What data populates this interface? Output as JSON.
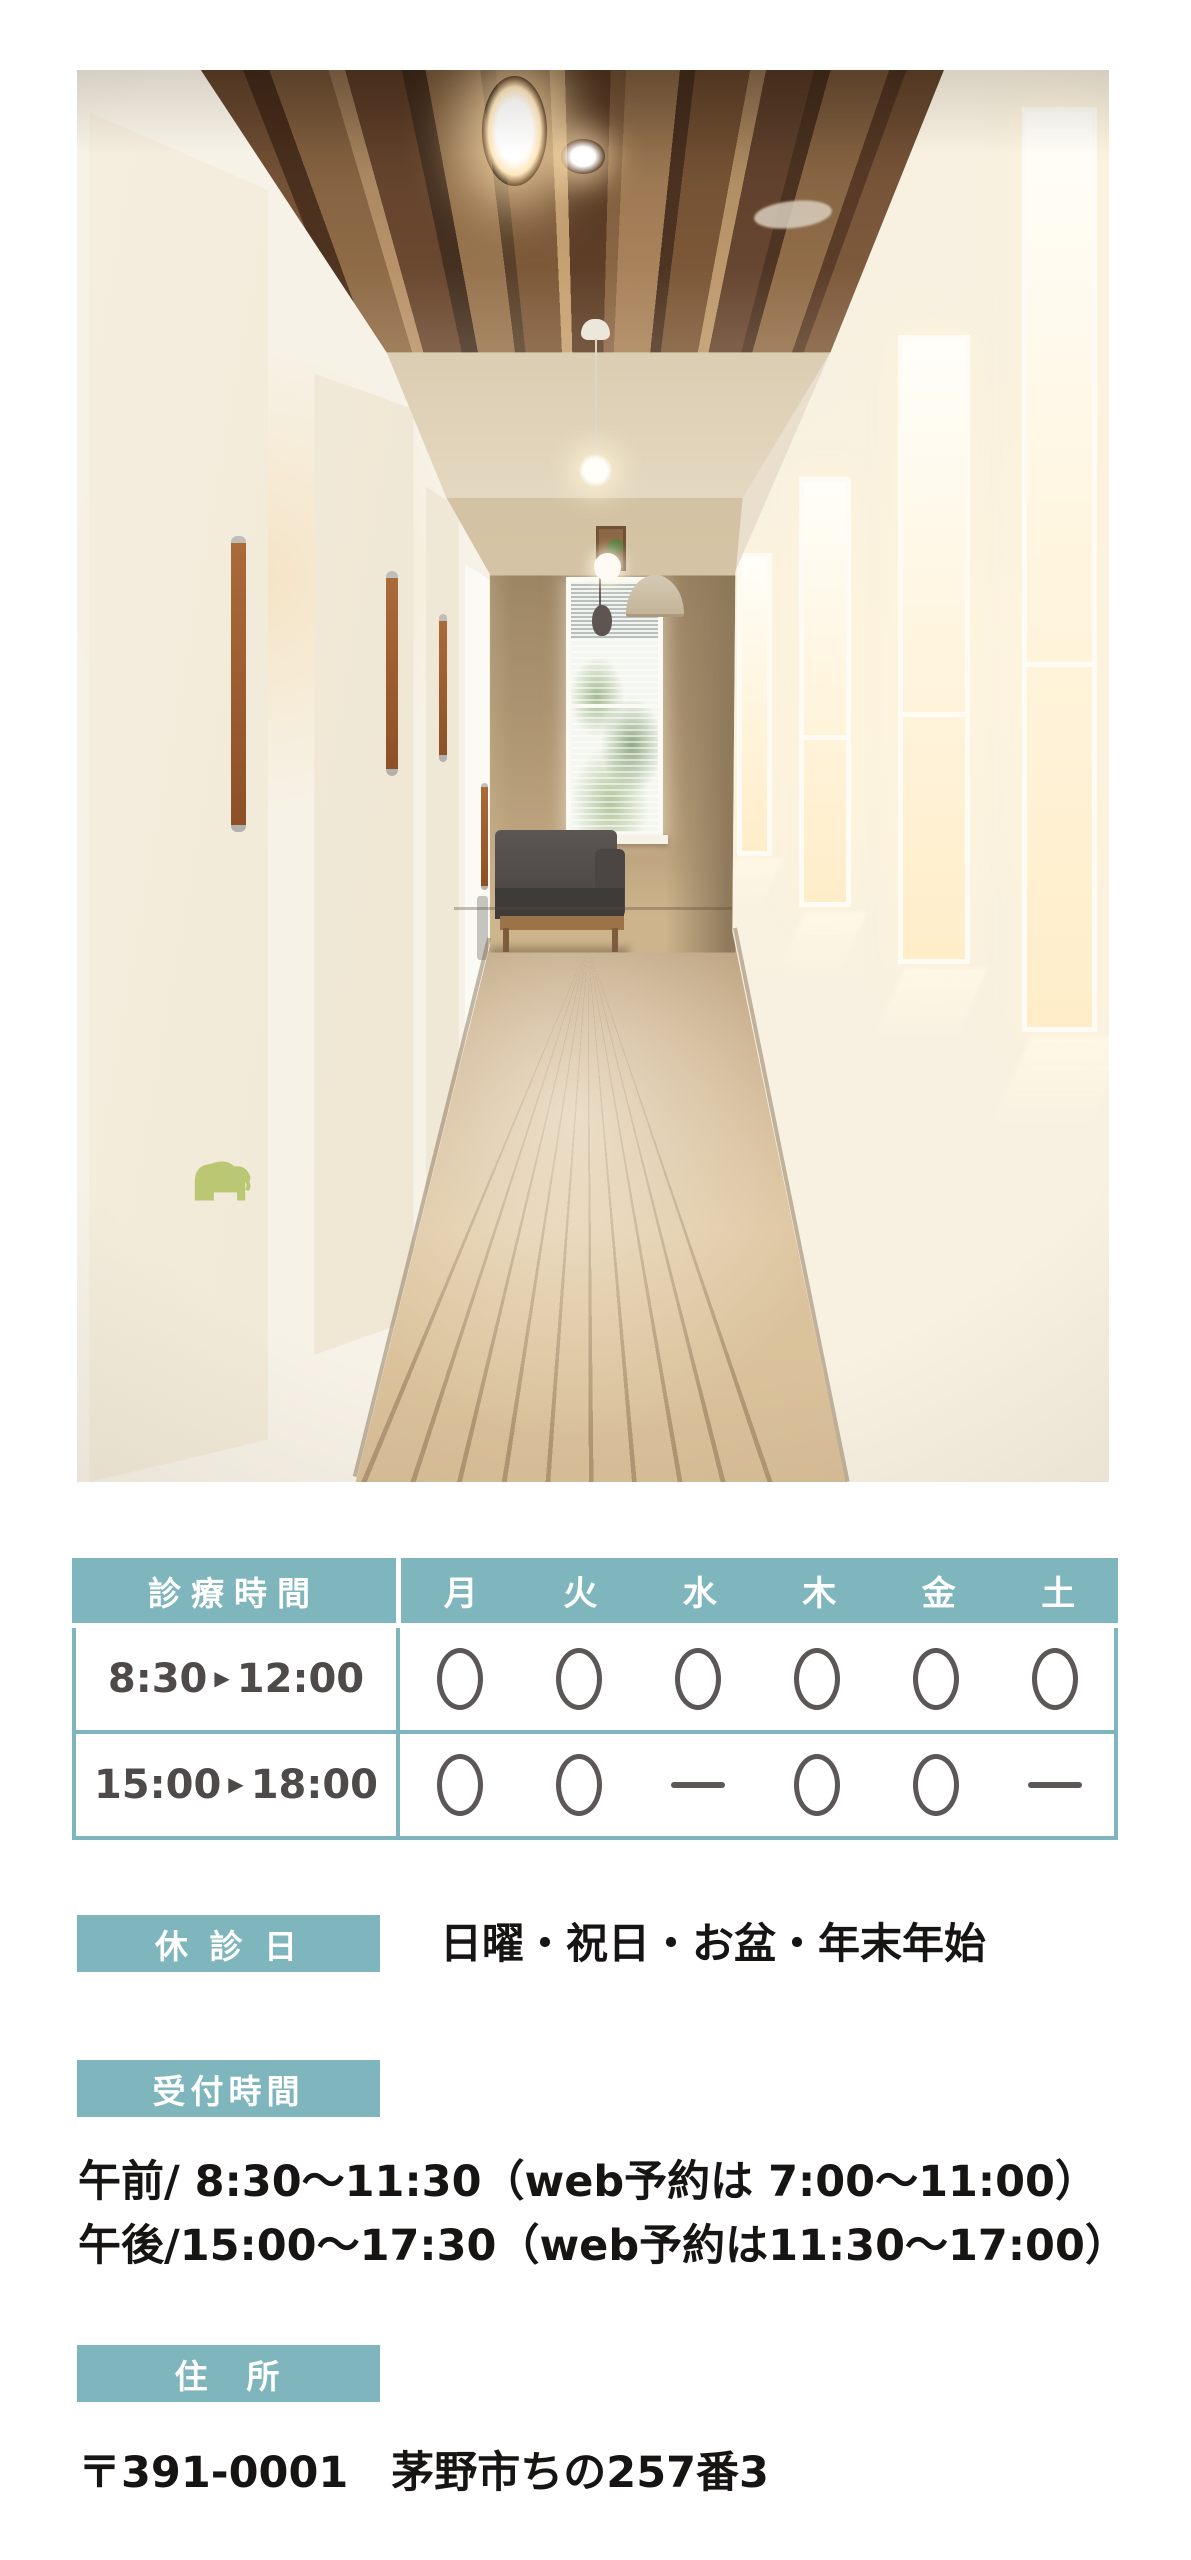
{
  "photo": {
    "label": "clinic-hallway-interior-photo"
  },
  "colors": {
    "teal": "#7fb6be",
    "header_text": "#ffffff",
    "mark": "#5b5757",
    "time_text": "#4e4a4a",
    "body_text": "#171414"
  },
  "schedule": {
    "corner_label": "診療時間",
    "days": [
      "月",
      "火",
      "水",
      "木",
      "金",
      "土"
    ],
    "rows": [
      {
        "time": "8:30▶12:00",
        "marks": [
          "open",
          "open",
          "open",
          "open",
          "open",
          "open"
        ]
      },
      {
        "time": "15:00▶18:00",
        "marks": [
          "open",
          "open",
          "closed",
          "open",
          "open",
          "closed"
        ]
      }
    ]
  },
  "closed_days": {
    "label": "休 診 日",
    "text": "日曜・祝日・お盆・年末年始"
  },
  "reception": {
    "label": "受付時間",
    "lines": [
      "午前/ 8:30～11:30（web予約は 7:00～11:00）",
      "午後/15:00～17:30（web予約は11:30～17:00）"
    ]
  },
  "address": {
    "label": "住　所",
    "text": "〒391-0001　茅野市ちの257番3"
  }
}
